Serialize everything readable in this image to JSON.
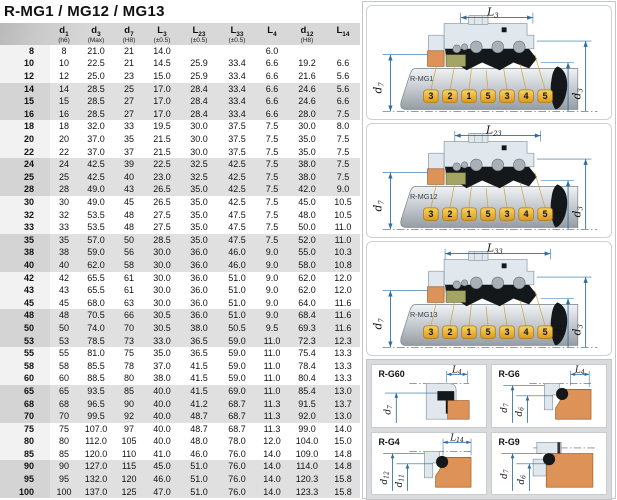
{
  "title": "R-MG1 / MG12 / MG13",
  "table": {
    "columns": [
      {
        "main": "d",
        "sub": "1",
        "note": "(h6)"
      },
      {
        "main": "d",
        "sub": "3",
        "note": "(Max)"
      },
      {
        "main": "d",
        "sub": "7",
        "note": "(H8)"
      },
      {
        "main": "L",
        "sub": "3",
        "note": "(±0.5)"
      },
      {
        "main": "L",
        "sub": "23",
        "note": "(±0.5)"
      },
      {
        "main": "L",
        "sub": "33",
        "note": "(±0.5)"
      },
      {
        "main": "L",
        "sub": "4",
        "note": ""
      },
      {
        "main": "d",
        "sub": "12",
        "note": "(H8)"
      },
      {
        "main": "L",
        "sub": "14",
        "note": ""
      }
    ],
    "rows": [
      [
        "8",
        "8",
        "21.0",
        "21",
        "14.0",
        "",
        "",
        "6.0",
        "",
        ""
      ],
      [
        "10",
        "10",
        "22.5",
        "21",
        "14.5",
        "25.9",
        "33.4",
        "6.6",
        "19.2",
        "6.6"
      ],
      [
        "12",
        "12",
        "25.0",
        "23",
        "15.0",
        "25.9",
        "33.4",
        "6.6",
        "21.6",
        "5.6"
      ],
      [
        "14",
        "14",
        "28.5",
        "25",
        "17.0",
        "28.4",
        "33.4",
        "6.6",
        "24.6",
        "5.6"
      ],
      [
        "15",
        "15",
        "28.5",
        "27",
        "17.0",
        "28.4",
        "33.4",
        "6.6",
        "24.6",
        "6.6"
      ],
      [
        "16",
        "16",
        "28.5",
        "27",
        "17.0",
        "28.4",
        "33.4",
        "6.6",
        "28.0",
        "7.5"
      ],
      [
        "18",
        "18",
        "32.0",
        "33",
        "19.5",
        "30.0",
        "37.5",
        "7.5",
        "30.0",
        "8.0"
      ],
      [
        "20",
        "20",
        "37.0",
        "35",
        "21.5",
        "30.0",
        "37.5",
        "7.5",
        "35.0",
        "7.5"
      ],
      [
        "22",
        "22",
        "37.0",
        "37",
        "21.5",
        "30.0",
        "37.5",
        "7.5",
        "35.0",
        "7.5"
      ],
      [
        "24",
        "24",
        "42.5",
        "39",
        "22.5",
        "32.5",
        "42.5",
        "7.5",
        "38.0",
        "7.5"
      ],
      [
        "25",
        "25",
        "42.5",
        "40",
        "23.0",
        "32.5",
        "42.5",
        "7.5",
        "38.0",
        "7.5"
      ],
      [
        "28",
        "28",
        "49.0",
        "43",
        "26.5",
        "35.0",
        "42.5",
        "7.5",
        "42.0",
        "9.0"
      ],
      [
        "30",
        "30",
        "49.0",
        "45",
        "26.5",
        "35.0",
        "42.5",
        "7.5",
        "45.0",
        "10.5"
      ],
      [
        "32",
        "32",
        "53.5",
        "48",
        "27.5",
        "35.0",
        "47.5",
        "7.5",
        "48.0",
        "10.5"
      ],
      [
        "33",
        "33",
        "53.5",
        "48",
        "27.5",
        "35.0",
        "47.5",
        "7.5",
        "50.0",
        "11.0"
      ],
      [
        "35",
        "35",
        "57.0",
        "50",
        "28.5",
        "35.0",
        "47.5",
        "7.5",
        "52.0",
        "11.0"
      ],
      [
        "38",
        "38",
        "59.0",
        "56",
        "30.0",
        "36.0",
        "46.0",
        "9.0",
        "55.0",
        "10.3"
      ],
      [
        "40",
        "40",
        "62.0",
        "58",
        "30.0",
        "36.0",
        "46.0",
        "9.0",
        "58.0",
        "10.8"
      ],
      [
        "42",
        "42",
        "65.5",
        "61",
        "30.0",
        "36.0",
        "51.0",
        "9.0",
        "62.0",
        "12.0"
      ],
      [
        "43",
        "43",
        "65.5",
        "61",
        "30.0",
        "36.0",
        "51.0",
        "9.0",
        "62.0",
        "12.0"
      ],
      [
        "45",
        "45",
        "68.0",
        "63",
        "30.0",
        "36.0",
        "51.0",
        "9.0",
        "64.0",
        "11.6"
      ],
      [
        "48",
        "48",
        "70.5",
        "66",
        "30.5",
        "36.0",
        "51.0",
        "9.0",
        "68.4",
        "11.6"
      ],
      [
        "50",
        "50",
        "74.0",
        "70",
        "30.5",
        "38.0",
        "50.5",
        "9.5",
        "69.3",
        "11.6"
      ],
      [
        "53",
        "53",
        "78.5",
        "73",
        "33.0",
        "36.5",
        "59.0",
        "11.0",
        "72.3",
        "12.3"
      ],
      [
        "55",
        "55",
        "81.0",
        "75",
        "35.0",
        "36.5",
        "59.0",
        "11.0",
        "75.4",
        "13.3"
      ],
      [
        "58",
        "58",
        "85.5",
        "78",
        "37.0",
        "41.5",
        "59.0",
        "11.0",
        "78.4",
        "13.3"
      ],
      [
        "60",
        "60",
        "88.5",
        "80",
        "38.0",
        "41.5",
        "59.0",
        "11.0",
        "80.4",
        "13.3"
      ],
      [
        "65",
        "65",
        "93.5",
        "85",
        "40.0",
        "41.5",
        "69.0",
        "11.0",
        "85.4",
        "13.0"
      ],
      [
        "68",
        "68",
        "96.5",
        "90",
        "40.0",
        "41.2",
        "68.7",
        "11.3",
        "91.5",
        "13.7"
      ],
      [
        "70",
        "70",
        "99.5",
        "92",
        "40.0",
        "48.7",
        "68.7",
        "11.3",
        "92.0",
        "13.0"
      ],
      [
        "75",
        "75",
        "107.0",
        "97",
        "40.0",
        "48.7",
        "68.7",
        "11.3",
        "99.0",
        "14.0"
      ],
      [
        "80",
        "80",
        "112.0",
        "105",
        "40.0",
        "48.0",
        "78.0",
        "12.0",
        "104.0",
        "15.0"
      ],
      [
        "85",
        "85",
        "120.0",
        "110",
        "41.0",
        "46.0",
        "76.0",
        "14.0",
        "109.0",
        "14.8"
      ],
      [
        "90",
        "90",
        "127.0",
        "115",
        "45.0",
        "51.0",
        "76.0",
        "14.0",
        "114.0",
        "14.8"
      ],
      [
        "95",
        "95",
        "132.0",
        "120",
        "46.0",
        "51.0",
        "76.0",
        "14.0",
        "120.3",
        "15.8"
      ],
      [
        "100",
        "100",
        "137.0",
        "125",
        "47.0",
        "51.0",
        "76.0",
        "14.0",
        "123.3",
        "15.8"
      ]
    ]
  },
  "callouts": [
    "3",
    "2",
    "1",
    "5",
    "3",
    "4",
    "5"
  ],
  "diagrams": [
    {
      "label": "R-MG1",
      "dim_top": {
        "main": "L",
        "sub": "3"
      },
      "dim_left": {
        "main": "d",
        "sub": "7"
      },
      "dim_right_inner": {
        "main": "d",
        "sub": "1"
      },
      "dim_right_outer": {
        "main": "d",
        "sub": "3"
      }
    },
    {
      "label": "R-MG12",
      "dim_top": {
        "main": "L",
        "sub": "23"
      },
      "dim_left": {
        "main": "d",
        "sub": "7"
      },
      "dim_right_inner": {
        "main": "d",
        "sub": "1"
      },
      "dim_right_outer": {
        "main": "d",
        "sub": "3"
      }
    },
    {
      "label": "R-MG13",
      "dim_top": {
        "main": "L",
        "sub": "33"
      },
      "dim_left": {
        "main": "d",
        "sub": "7"
      },
      "dim_right_inner": {
        "main": "d",
        "sub": "1"
      },
      "dim_right_outer": {
        "main": "d",
        "sub": "3"
      }
    }
  ],
  "seats": [
    {
      "label": "R-G60",
      "dim_top": {
        "main": "L",
        "sub": "4"
      },
      "dim_left_outer": {
        "main": "d",
        "sub": "7"
      }
    },
    {
      "label": "R-G6",
      "dim_top": {
        "main": "L",
        "sub": "4"
      },
      "dim_left_outer": {
        "main": "d",
        "sub": "7"
      },
      "dim_left_inner": {
        "main": "d",
        "sub": "6"
      }
    },
    {
      "label": "R-G4",
      "dim_top": {
        "main": "L",
        "sub": "14"
      },
      "dim_left_outer": {
        "main": "d",
        "sub": "12"
      },
      "dim_left_inner": {
        "main": "d",
        "sub": "11"
      }
    },
    {
      "label": "R-G9",
      "dim_left_outer": {
        "main": "d",
        "sub": "7"
      },
      "dim_left_inner": {
        "main": "d",
        "sub": "6"
      }
    }
  ],
  "colors": {
    "header_gray": "#d8d8d8",
    "band_gray": "#e0e0e0",
    "dim_blue": "#2e6da0",
    "callout_gold": "#eebe3e",
    "seat_orange": "#dd9257",
    "olive": "#a3a565",
    "black_part": "#15181b"
  }
}
